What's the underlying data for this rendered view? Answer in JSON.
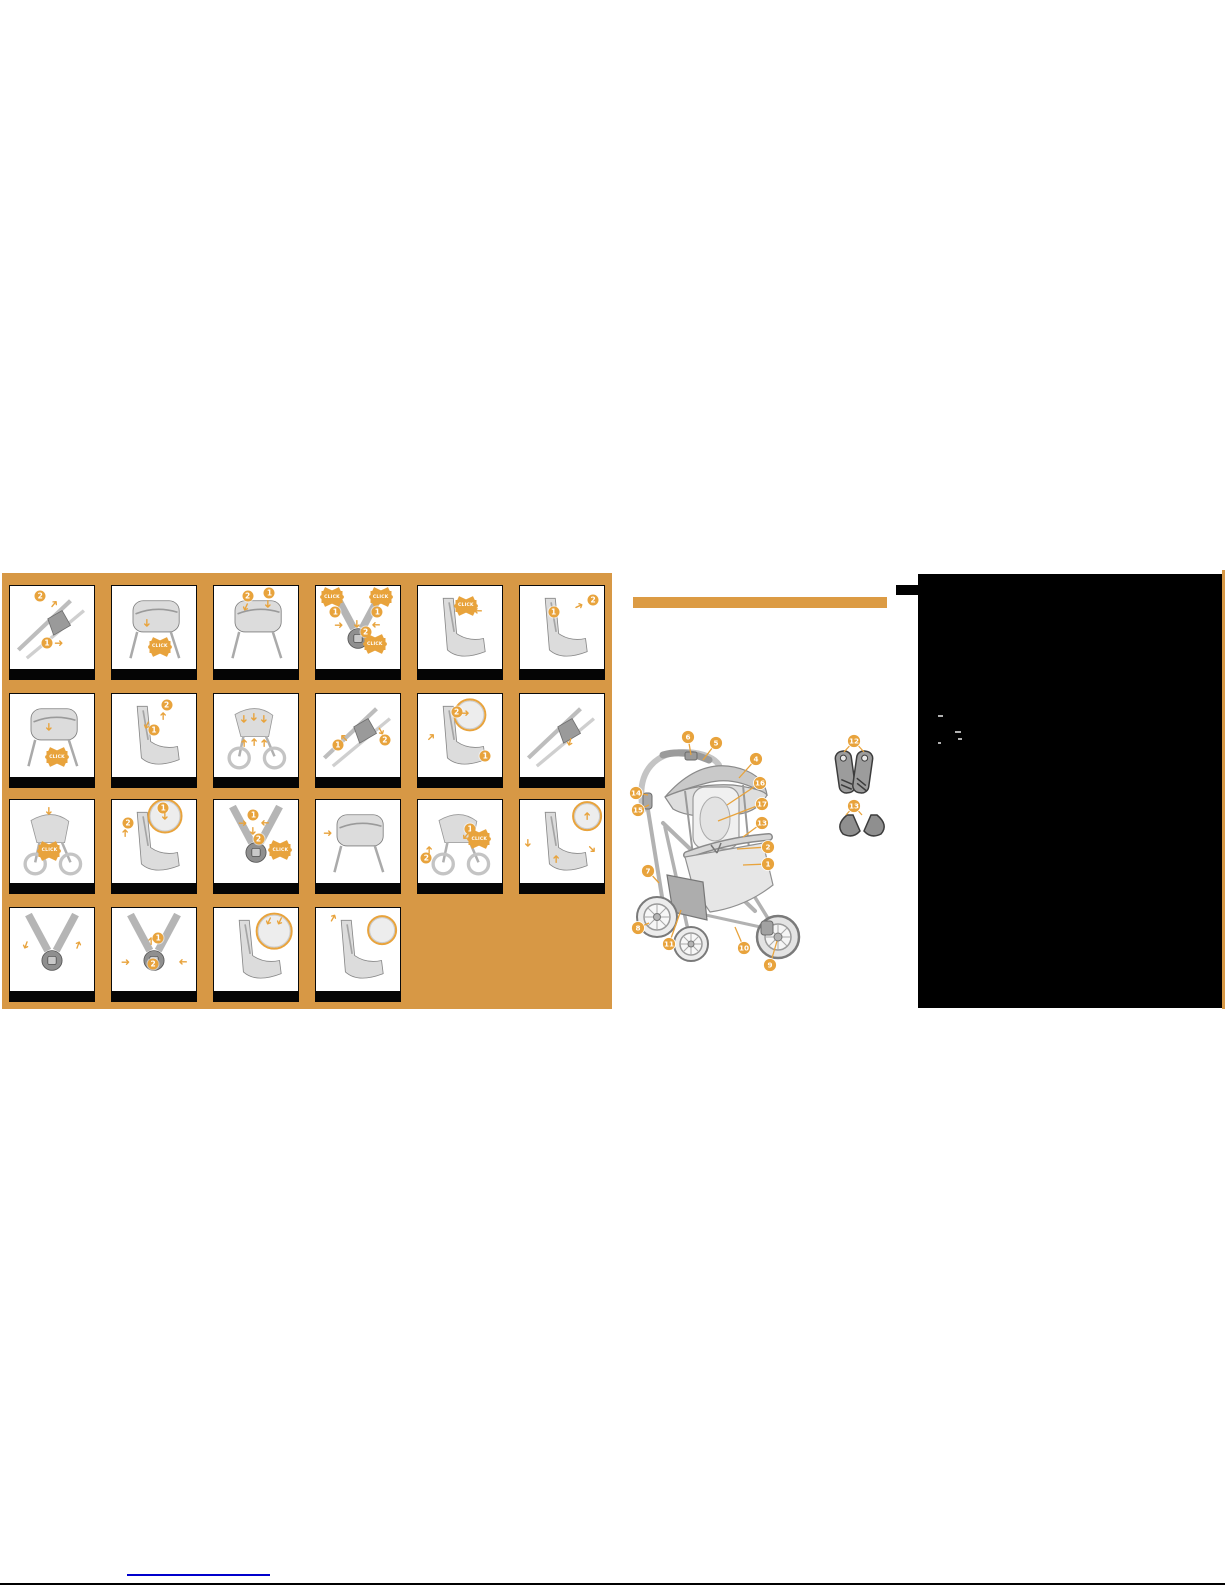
{
  "document": {
    "kind": "stroller instruction manual page"
  },
  "colors": {
    "panel_orange": "#D79845",
    "accent_orange": "#E8A33C",
    "bar_orange": "#DC9B44",
    "link_blue": "#0000CC",
    "panel_black": "#000000"
  },
  "instruction_grid": {
    "click_label": "CLICK",
    "columns": [
      7,
      109,
      211,
      313,
      415,
      517
    ],
    "rows": [
      12,
      120,
      226,
      334
    ],
    "panel_w": 86,
    "panel_h": 95,
    "panels": [
      {
        "id": 1,
        "col": 0,
        "row": 0,
        "sketch": "frame",
        "annotations": [
          {
            "type": "num",
            "value": "2",
            "x": 36,
            "y": 12
          },
          {
            "type": "arrow",
            "rot": -50,
            "x": 52,
            "y": 22
          },
          {
            "type": "num",
            "value": "1",
            "x": 44,
            "y": 70
          },
          {
            "type": "arrow",
            "rot": 0,
            "x": 58,
            "y": 70
          }
        ]
      },
      {
        "id": 2,
        "col": 1,
        "row": 0,
        "sketch": "box",
        "annotations": [
          {
            "type": "arrow",
            "rot": 90,
            "x": 42,
            "y": 45
          },
          {
            "type": "click",
            "x": 57,
            "y": 74
          }
        ]
      },
      {
        "id": 3,
        "col": 2,
        "row": 0,
        "sketch": "box",
        "annotations": [
          {
            "type": "num",
            "value": "2",
            "x": 40,
            "y": 12
          },
          {
            "type": "arrow",
            "rot": 115,
            "x": 38,
            "y": 26
          },
          {
            "type": "num",
            "value": "1",
            "x": 66,
            "y": 9
          },
          {
            "type": "arrow",
            "rot": 90,
            "x": 64,
            "y": 22
          }
        ]
      },
      {
        "id": 4,
        "col": 3,
        "row": 0,
        "sketch": "harness",
        "annotations": [
          {
            "type": "click",
            "x": 19,
            "y": 14
          },
          {
            "type": "click",
            "x": 77,
            "y": 14
          },
          {
            "type": "num",
            "value": "1",
            "x": 23,
            "y": 32
          },
          {
            "type": "num",
            "value": "1",
            "x": 73,
            "y": 32
          },
          {
            "type": "arrow",
            "rot": 0,
            "x": 27,
            "y": 47
          },
          {
            "type": "arrow",
            "rot": 180,
            "x": 71,
            "y": 47
          },
          {
            "type": "arrow",
            "rot": 90,
            "x": 49,
            "y": 46
          },
          {
            "type": "num",
            "value": "2",
            "x": 59,
            "y": 56
          },
          {
            "type": "click",
            "x": 70,
            "y": 71
          }
        ]
      },
      {
        "id": 5,
        "col": 4,
        "row": 0,
        "sketch": "seat",
        "annotations": [
          {
            "type": "click",
            "x": 57,
            "y": 24
          },
          {
            "type": "arrow",
            "rot": 180,
            "x": 72,
            "y": 30
          }
        ]
      },
      {
        "id": 6,
        "col": 5,
        "row": 0,
        "sketch": "seat",
        "annotations": [
          {
            "type": "num",
            "value": "1",
            "x": 40,
            "y": 32
          },
          {
            "type": "arrow",
            "rot": -25,
            "x": 70,
            "y": 24
          },
          {
            "type": "num",
            "value": "2",
            "x": 87,
            "y": 17
          }
        ]
      },
      {
        "id": 7,
        "col": 0,
        "row": 1,
        "sketch": "box",
        "annotations": [
          {
            "type": "arrow",
            "rot": 90,
            "x": 46,
            "y": 40
          },
          {
            "type": "click",
            "x": 56,
            "y": 77
          }
        ]
      },
      {
        "id": 8,
        "col": 1,
        "row": 1,
        "sketch": "seat",
        "annotations": [
          {
            "type": "num",
            "value": "2",
            "x": 65,
            "y": 14
          },
          {
            "type": "arrow",
            "rot": -90,
            "x": 61,
            "y": 27
          },
          {
            "type": "num",
            "value": "1",
            "x": 50,
            "y": 44
          },
          {
            "type": "arrow",
            "rot": 115,
            "x": 42,
            "y": 38
          }
        ]
      },
      {
        "id": 9,
        "col": 2,
        "row": 1,
        "sketch": "chassis",
        "annotations": [
          {
            "type": "arrow",
            "rot": 90,
            "x": 36,
            "y": 30
          },
          {
            "type": "arrow",
            "rot": 90,
            "x": 48,
            "y": 28
          },
          {
            "type": "arrow",
            "rot": 90,
            "x": 60,
            "y": 30
          },
          {
            "type": "arrow",
            "rot": -90,
            "x": 36,
            "y": 60
          },
          {
            "type": "arrow",
            "rot": -90,
            "x": 48,
            "y": 58
          },
          {
            "type": "arrow",
            "rot": -90,
            "x": 60,
            "y": 60
          }
        ]
      },
      {
        "id": 10,
        "col": 3,
        "row": 1,
        "sketch": "frame",
        "annotations": [
          {
            "type": "num",
            "value": "1",
            "x": 26,
            "y": 62
          },
          {
            "type": "arrow",
            "rot": -135,
            "x": 33,
            "y": 54
          },
          {
            "type": "num",
            "value": "2",
            "x": 82,
            "y": 56
          },
          {
            "type": "arrow",
            "rot": 60,
            "x": 77,
            "y": 45
          }
        ]
      },
      {
        "id": 11,
        "col": 4,
        "row": 1,
        "sketch": "seat",
        "annotations": [
          {
            "type": "detail",
            "x": 62,
            "y": 25,
            "d": 34
          },
          {
            "type": "num",
            "value": "2",
            "x": 46,
            "y": 22
          },
          {
            "type": "arrow",
            "rot": 0,
            "x": 56,
            "y": 23
          },
          {
            "type": "arrow",
            "rot": -45,
            "x": 16,
            "y": 52
          },
          {
            "type": "num",
            "value": "1",
            "x": 80,
            "y": 76
          }
        ]
      },
      {
        "id": 12,
        "col": 5,
        "row": 1,
        "sketch": "frame",
        "annotations": [
          {
            "type": "arrow",
            "rot": 105,
            "x": 60,
            "y": 58
          }
        ]
      },
      {
        "id": 13,
        "col": 0,
        "row": 2,
        "sketch": "chassis",
        "annotations": [
          {
            "type": "arrow",
            "rot": 90,
            "x": 46,
            "y": 14
          },
          {
            "type": "click",
            "x": 47,
            "y": 62
          }
        ]
      },
      {
        "id": 14,
        "col": 1,
        "row": 2,
        "sketch": "seat",
        "annotations": [
          {
            "type": "num",
            "value": "2",
            "x": 19,
            "y": 28
          },
          {
            "type": "arrow",
            "rot": -90,
            "x": 16,
            "y": 40
          },
          {
            "type": "detail",
            "x": 63,
            "y": 20,
            "d": 36
          },
          {
            "type": "num",
            "value": "1",
            "x": 61,
            "y": 10
          },
          {
            "type": "arrow",
            "rot": 90,
            "x": 63,
            "y": 20
          }
        ]
      },
      {
        "id": 15,
        "col": 2,
        "row": 2,
        "sketch": "harness",
        "annotations": [
          {
            "type": "num",
            "value": "1",
            "x": 47,
            "y": 18
          },
          {
            "type": "arrow",
            "rot": 0,
            "x": 34,
            "y": 28
          },
          {
            "type": "arrow",
            "rot": 180,
            "x": 61,
            "y": 28
          },
          {
            "type": "arrow",
            "rot": 90,
            "x": 47,
            "y": 38
          },
          {
            "type": "num",
            "value": "2",
            "x": 53,
            "y": 48
          },
          {
            "type": "click",
            "x": 79,
            "y": 61
          }
        ]
      },
      {
        "id": 16,
        "col": 3,
        "row": 2,
        "sketch": "box",
        "annotations": [
          {
            "type": "arrow",
            "rot": 0,
            "x": 14,
            "y": 40
          }
        ]
      },
      {
        "id": 17,
        "col": 4,
        "row": 2,
        "sketch": "chassis",
        "annotations": [
          {
            "type": "num",
            "value": "1",
            "x": 62,
            "y": 35
          },
          {
            "type": "arrow",
            "rot": 130,
            "x": 57,
            "y": 44
          },
          {
            "type": "click",
            "x": 73,
            "y": 48
          },
          {
            "type": "num",
            "value": "2",
            "x": 10,
            "y": 71
          },
          {
            "type": "arrow",
            "rot": -90,
            "x": 13,
            "y": 61
          }
        ]
      },
      {
        "id": 18,
        "col": 5,
        "row": 2,
        "sketch": "seat",
        "annotations": [
          {
            "type": "detail",
            "x": 80,
            "y": 20,
            "d": 30
          },
          {
            "type": "arrow",
            "rot": -90,
            "x": 80,
            "y": 20
          },
          {
            "type": "arrow",
            "rot": 90,
            "x": 10,
            "y": 52
          },
          {
            "type": "arrow",
            "rot": -90,
            "x": 43,
            "y": 72
          },
          {
            "type": "arrow",
            "rot": 45,
            "x": 86,
            "y": 60
          }
        ]
      },
      {
        "id": 19,
        "col": 0,
        "row": 3,
        "sketch": "harness",
        "annotations": [
          {
            "type": "arrow",
            "rot": 110,
            "x": 19,
            "y": 45
          },
          {
            "type": "arrow",
            "rot": -70,
            "x": 81,
            "y": 45
          }
        ]
      },
      {
        "id": 20,
        "col": 1,
        "row": 3,
        "sketch": "harness",
        "annotations": [
          {
            "type": "arrow",
            "rot": -90,
            "x": 46,
            "y": 40
          },
          {
            "type": "num",
            "value": "1",
            "x": 55,
            "y": 36
          },
          {
            "type": "arrow",
            "rot": 0,
            "x": 16,
            "y": 66
          },
          {
            "type": "arrow",
            "rot": 180,
            "x": 84,
            "y": 66
          },
          {
            "type": "num",
            "value": "2",
            "x": 49,
            "y": 68
          }
        ]
      },
      {
        "id": 21,
        "col": 2,
        "row": 3,
        "sketch": "seat",
        "annotations": [
          {
            "type": "detail",
            "x": 72,
            "y": 28,
            "d": 38
          },
          {
            "type": "arrow",
            "rot": 115,
            "x": 66,
            "y": 16
          },
          {
            "type": "arrow",
            "rot": 115,
            "x": 78,
            "y": 16
          }
        ]
      },
      {
        "id": 22,
        "col": 3,
        "row": 3,
        "sketch": "seat",
        "annotations": [
          {
            "type": "arrow",
            "rot": -60,
            "x": 20,
            "y": 12
          },
          {
            "type": "detail",
            "x": 79,
            "y": 27,
            "d": 30
          }
        ]
      }
    ]
  },
  "parts_diagram": {
    "callouts": [
      {
        "label": "6",
        "cx": 73,
        "cy": 22,
        "targets": [
          [
            76,
            40
          ]
        ]
      },
      {
        "label": "5",
        "cx": 101,
        "cy": 28,
        "targets": [
          [
            88,
            45
          ]
        ]
      },
      {
        "label": "4",
        "cx": 141,
        "cy": 44,
        "targets": [
          [
            124,
            63
          ]
        ]
      },
      {
        "label": "16",
        "cx": 145,
        "cy": 68,
        "targets": [
          [
            112,
            90
          ]
        ]
      },
      {
        "label": "17",
        "cx": 147,
        "cy": 89,
        "targets": [
          [
            103,
            106
          ]
        ]
      },
      {
        "label": "13",
        "cx": 147,
        "cy": 108,
        "targets": [
          [
            128,
            122
          ]
        ]
      },
      {
        "label": "2",
        "cx": 153,
        "cy": 132,
        "targets": [
          [
            122,
            134
          ]
        ]
      },
      {
        "label": "1",
        "cx": 153,
        "cy": 149,
        "targets": [
          [
            128,
            150
          ]
        ]
      },
      {
        "label": "14",
        "cx": 21,
        "cy": 78,
        "targets": [
          [
            33,
            80
          ]
        ]
      },
      {
        "label": "15",
        "cx": 23,
        "cy": 95,
        "targets": [
          [
            34,
            90
          ]
        ]
      },
      {
        "label": "7",
        "cx": 33,
        "cy": 156,
        "targets": [
          [
            44,
            168
          ]
        ]
      },
      {
        "label": "8",
        "cx": 23,
        "cy": 213,
        "targets": [
          [
            34,
            208
          ]
        ]
      },
      {
        "label": "11",
        "cx": 54,
        "cy": 229,
        "targets": [
          [
            66,
            195
          ]
        ]
      },
      {
        "label": "10",
        "cx": 129,
        "cy": 233,
        "targets": [
          [
            120,
            212
          ]
        ]
      },
      {
        "label": "9",
        "cx": 155,
        "cy": 250,
        "targets": [
          [
            162,
            226
          ]
        ]
      },
      {
        "label": "12",
        "cx": 239,
        "cy": 26,
        "targets": [
          [
            229,
            37
          ],
          [
            249,
            37
          ]
        ]
      },
      {
        "label": "13",
        "cx": 239,
        "cy": 91,
        "targets": [
          [
            231,
            100
          ],
          [
            247,
            100
          ]
        ]
      }
    ]
  },
  "footer": {
    "link_present": true
  }
}
